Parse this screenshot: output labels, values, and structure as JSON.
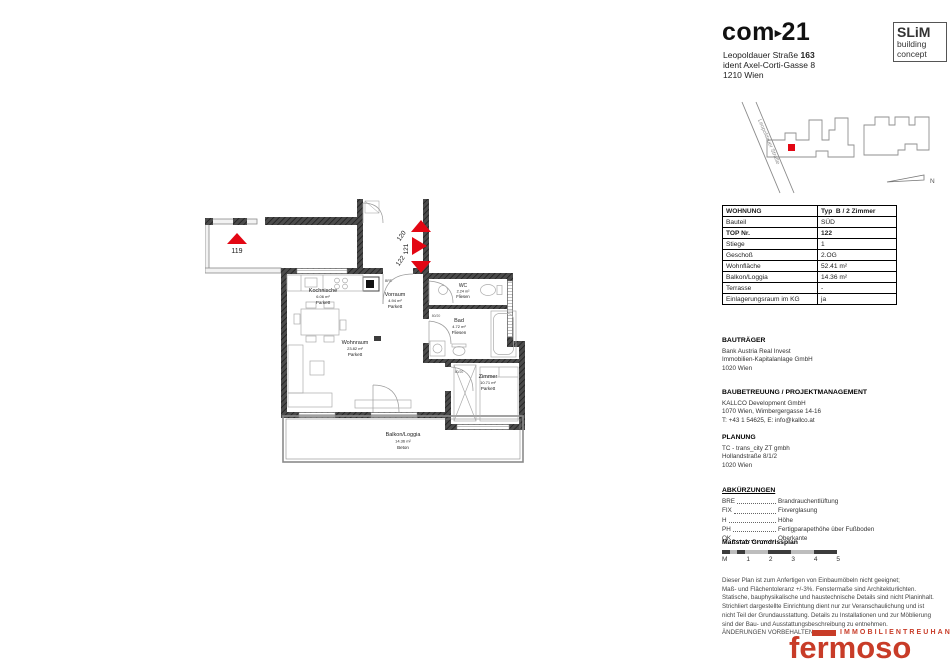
{
  "header": {
    "logo_text": "com",
    "logo_arrow": "▸",
    "logo_number": "21",
    "address_street": "Leopoldauer Straße",
    "address_number": "163",
    "address_line2": "ident Axel-Corti-Gasse 8",
    "address_line3": "1210 Wien",
    "slim_box": {
      "line1": "SLiM",
      "line2": "building",
      "line3": "concept"
    }
  },
  "site_map": {
    "street": "Leopoldauer Straße",
    "north": "N",
    "marker_color": "#e30613"
  },
  "unit_table": {
    "rows": [
      {
        "label": "WOHNUNG",
        "value": "Typ  B / 2 Zimmer"
      },
      {
        "label": "Bauteil",
        "value": "SÜD"
      },
      {
        "label": "TOP Nr.",
        "value": "122"
      },
      {
        "label": "Stiege",
        "value": "1"
      },
      {
        "label": "Geschoß",
        "value": "2.OG"
      },
      {
        "label": "Wohnfläche",
        "value": "52.41 m²"
      },
      {
        "label": "Balkon/Loggia",
        "value": "14.36 m²"
      },
      {
        "label": "Terrasse",
        "value": "-"
      },
      {
        "label": "Einlagerungsraum im KG",
        "value": "ja"
      }
    ]
  },
  "contacts": [
    {
      "heading": "BAUTRÄGER",
      "lines": [
        "Bank Austria Real Invest",
        "Immobilien-Kapitalanlage GmbH",
        "1020 Wien"
      ]
    },
    {
      "heading": "BAUBETREUUNG / PROJEKTMANAGEMENT",
      "lines": [
        "KALLCO Development GmbH",
        "1070 Wien, Wimbergergasse 14-16",
        "T: +43 1 54625, E: info@kallco.at"
      ]
    },
    {
      "heading": "PLANUNG",
      "lines": [
        "TC - trans_city ZT gmbh",
        "Hollandstraße 8/1/2",
        "1020 Wien"
      ]
    }
  ],
  "abbreviations": {
    "heading": "ABKÜRZUNGEN",
    "items": [
      {
        "abbr": "BRE",
        "meaning": "Brandrauchentlüftung"
      },
      {
        "abbr": "FIX",
        "meaning": "Fixverglasung"
      },
      {
        "abbr": "H",
        "meaning": "Höhe"
      },
      {
        "abbr": "PH",
        "meaning": "Fertigparapethöhe über Fußboden"
      },
      {
        "abbr": "OK",
        "meaning": "Oberkante"
      }
    ]
  },
  "scale_bar": {
    "heading": "Maßstab Grundrissplan",
    "ticks": [
      "M",
      "1",
      "2",
      "3",
      "4",
      "5"
    ]
  },
  "disclaimer": {
    "lines": [
      "Dieser Plan ist zum Anfertigen von Einbaumöbeln nicht geeignet;",
      "Maß- und Flächentoleranz +/-3%. Fenstermaße sind Architekturlichten.",
      "Statische, bauphysikalische und haustechnische Details sind nicht Planinhalt.",
      "Strichliert dargestellte Einrichtung dient nur zur Veranschaulichung und ist",
      "nicht Teil der Grundausstattung. Details zu Installationen und zur Möblierung",
      "sind der Bau- und Ausstattungsbeschreibung zu entnehmen.",
      "ÄNDERUNGEN VORBEHALTEN"
    ]
  },
  "brand": {
    "tagline": "IMMOBILIENTREUHAND",
    "name": "fermoso",
    "color": "#c83c28"
  },
  "floor_plan": {
    "arrow_color": "#e30613",
    "door_label": "80/20",
    "shaft_label": "BRE",
    "markers": {
      "m119": "119",
      "m120": "120",
      "m121": "121",
      "m122": "122"
    },
    "rooms": {
      "kochnische": {
        "name": "Kochnische",
        "area": "6.06 m²",
        "floor": "Parkett"
      },
      "vorraum": {
        "name": "Vorraum",
        "area": "4.94 m²",
        "floor": "Parkett"
      },
      "wc": {
        "name": "WC",
        "area": "2.24 m²",
        "floor": "Fliesen"
      },
      "bad": {
        "name": "Bad",
        "area": "4.72 m²",
        "floor": "Fliesen"
      },
      "wohnraum": {
        "name": "Wohnraum",
        "area": "23.82 m²",
        "floor": "Parkett"
      },
      "zimmer": {
        "name": "Zimmer",
        "area": "10.71 m²",
        "floor": "Parkett"
      },
      "balkon": {
        "name": "Balkon/Loggia",
        "area": "14.36 m²",
        "floor": "Beton"
      }
    }
  }
}
